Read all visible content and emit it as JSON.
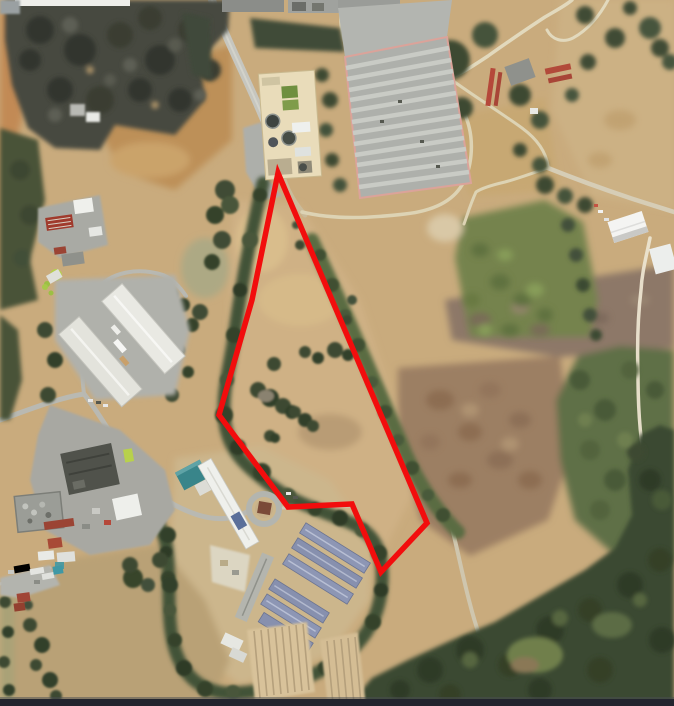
{
  "map": {
    "kind": "aerial-satellite-image",
    "image_width_px": 674,
    "image_height_px": 706,
    "boundary_overlay": {
      "description": "red parcel boundary outline drawn over aerial imagery",
      "color": "#f20d0d",
      "stroke_width": 5.5,
      "closed": true,
      "points": [
        [
          278,
          173
        ],
        [
          252,
          300
        ],
        [
          219,
          415
        ],
        [
          288,
          507
        ],
        [
          352,
          504
        ],
        [
          381,
          572
        ],
        [
          427,
          523
        ]
      ]
    },
    "palette": {
      "field_tan": "#c9ab7d",
      "field_light": "#d6bc8e",
      "hill_orange": "#c28a54",
      "field_brown": "#9c7f63",
      "field_mauve": "#8d7867",
      "pasture_green": "#74834d",
      "scrub_green": "#5f7046",
      "forest_dark": "#3b4831",
      "forest_charcoal": "#474a40",
      "tree_green": "#3c4a32",
      "road_gray": "#c2c2bb",
      "trail_cream": "#ddd3b4",
      "building_white": "#efefea",
      "building_gray": "#9a9a94",
      "building_dark": "#50524b",
      "plant_cream": "#e9dcba",
      "roof_blue": "#8d96b4",
      "roof_teal": "#39858a",
      "roof_red": "#a03a2c",
      "curb_pink": "#dba39a",
      "lime_green": "#b6d04e",
      "boundary_red": "#f20d0d"
    },
    "features": [
      {
        "name": "oak-woodland-top-left",
        "approx_center": [
          110,
          65
        ]
      },
      {
        "name": "access-road",
        "approx_center": [
          245,
          80
        ]
      },
      {
        "name": "wastewater-treatment-plant",
        "approx_center": [
          290,
          125
        ]
      },
      {
        "name": "striped-parking-lot",
        "approx_center": [
          408,
          115
        ]
      },
      {
        "name": "farmstead-red-rows",
        "approx_center": [
          520,
          80
        ]
      },
      {
        "name": "dirt-trails-top-right",
        "approx_center": [
          470,
          100
        ]
      },
      {
        "name": "white-barn",
        "approx_center": [
          628,
          227
        ]
      },
      {
        "name": "green-pasture",
        "approx_center": [
          525,
          275
        ]
      },
      {
        "name": "plowed-brown-field",
        "approx_center": [
          480,
          450
        ]
      },
      {
        "name": "riparian-tree-line",
        "approx_center": [
          280,
          500
        ]
      },
      {
        "name": "red-roof-barnyard",
        "approx_center": [
          70,
          228
        ]
      },
      {
        "name": "twin-warehouses",
        "approx_center": [
          120,
          345
        ]
      },
      {
        "name": "industrial-facility",
        "approx_center": [
          95,
          480
        ]
      },
      {
        "name": "campus-with-blue-roofs",
        "approx_center": [
          300,
          570
        ]
      },
      {
        "name": "round-driveway",
        "approx_center": [
          264,
          509
        ]
      },
      {
        "name": "crop-rows",
        "approx_center": [
          285,
          660
        ]
      },
      {
        "name": "farmyard-bottom-left",
        "approx_center": [
          35,
          585
        ]
      },
      {
        "name": "dense-forest-bottom-right",
        "approx_center": [
          550,
          640
        ]
      },
      {
        "name": "parcel-boundary",
        "approx_center": [
          320,
          370
        ]
      }
    ]
  }
}
